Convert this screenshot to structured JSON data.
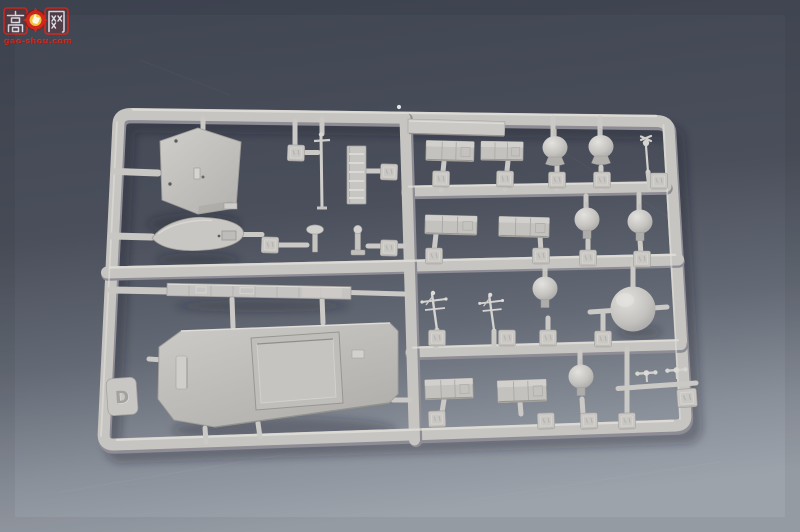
{
  "watermark": {
    "char_left": "高",
    "char_right": "网",
    "site": "gao-shou.com",
    "accent_red": "#d8281e",
    "emblem_yellow": "#f2c23c",
    "glyph_color": "#e9eff7"
  },
  "sprue": {
    "letter": "D",
    "description": "light grey injection-moulded plastic model sprue photographed on a dark blue-grey backdrop",
    "part_number_tags": 21,
    "plastic_color": "#c6c4c0",
    "plastic_highlight": "#e1dfda",
    "plastic_shadow": "#8e8c94",
    "parts": [
      "flat-bridge-plate",
      "ships-boat-hull",
      "mushroom-ventilator",
      "bollard-post",
      "signal-mast",
      "ladder-rack",
      "deck-beam",
      "superstructure-deck-with-hatch",
      "hull-side-strip",
      "equipment-box-1",
      "equipment-box-2",
      "equipment-box-3",
      "equipment-box-4",
      "equipment-box-5",
      "equipment-box-6",
      "onion-radome-1",
      "onion-radome-2",
      "ball-radome-1",
      "ball-radome-2",
      "ball-radome-3",
      "ball-radome-4",
      "large-radome-sphere",
      "yardarm-antenna-1",
      "yardarm-antenna-2",
      "whip-antenna",
      "dumbbell-antenna-pair"
    ]
  },
  "background": {
    "top": "#414653",
    "bottom": "#9da3ab"
  }
}
